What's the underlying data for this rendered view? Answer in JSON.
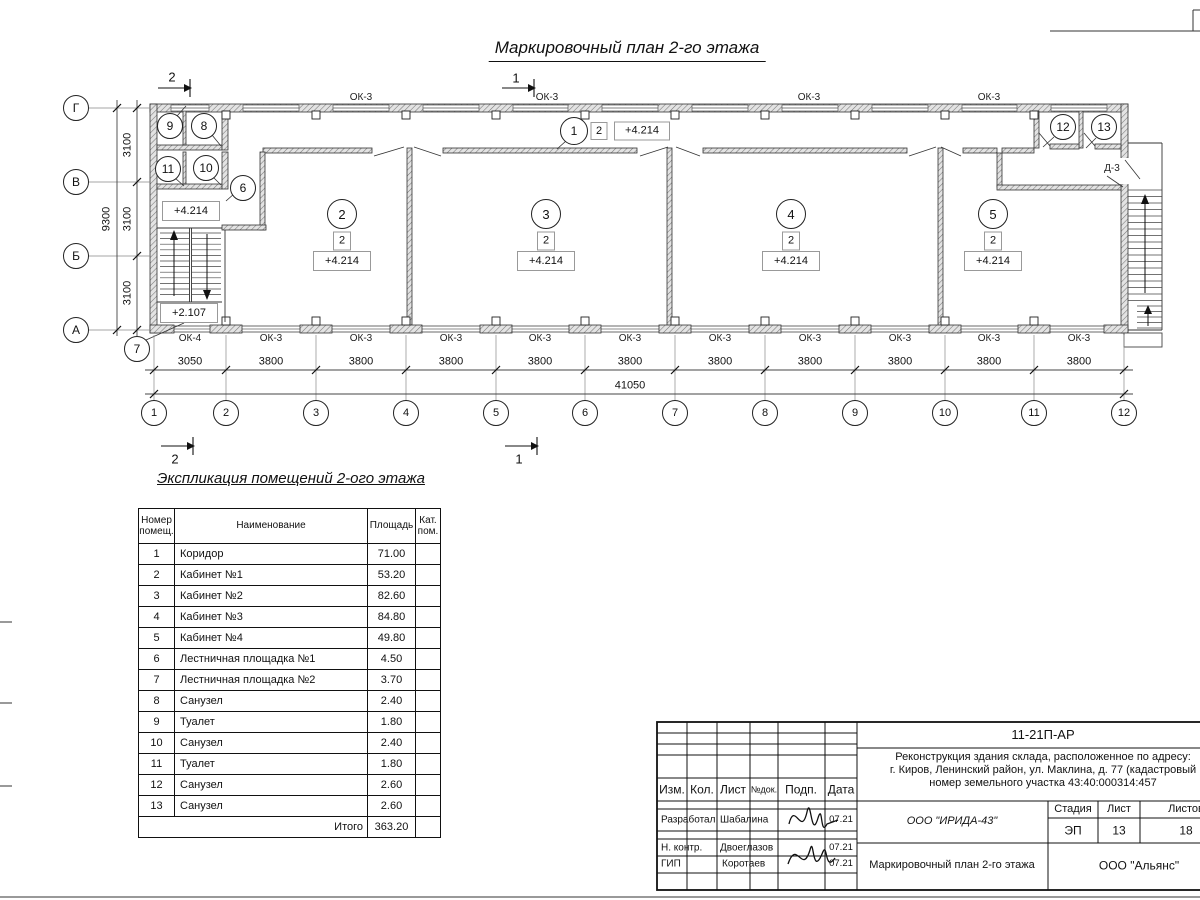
{
  "title": "Маркировочный план 2-го этажа",
  "plan": {
    "section_marks": {
      "top_left": "2",
      "top_mid": "1",
      "bottom_left": "2",
      "bottom_mid": "1"
    },
    "grid": {
      "cols": [
        "1",
        "2",
        "3",
        "4",
        "5",
        "6",
        "7",
        "8",
        "9",
        "10",
        "11",
        "12"
      ],
      "rows": [
        "Г",
        "В",
        "Б",
        "А"
      ]
    },
    "dims": {
      "bottom": [
        "3050",
        "3800",
        "3800",
        "3800",
        "3800",
        "3800",
        "3800",
        "3800",
        "3800",
        "3800",
        "3800"
      ],
      "total": "41050",
      "left": [
        "3100",
        "3100",
        "3100"
      ],
      "left_total": "9300"
    },
    "windows": {
      "top": [
        "ОК-3",
        "ОК-3",
        "ОК-3",
        "ОК-3"
      ],
      "bottom": [
        "ОК-4",
        "ОК-3",
        "ОК-3",
        "ОК-3",
        "ОК-3",
        "ОК-3",
        "ОК-3",
        "ОК-3",
        "ОК-3",
        "ОК-3",
        "ОК-3"
      ]
    },
    "corridor": {
      "no": "1",
      "type": "2",
      "elev": "+4.214"
    },
    "main_rooms": [
      {
        "no": "2",
        "type": "2",
        "elev": "+4.214"
      },
      {
        "no": "3",
        "type": "2",
        "elev": "+4.214"
      },
      {
        "no": "4",
        "type": "2",
        "elev": "+4.214"
      },
      {
        "no": "5",
        "type": "2",
        "elev": "+4.214"
      }
    ],
    "small_rooms": [
      "9",
      "8",
      "11",
      "10",
      "6",
      "7",
      "12",
      "13"
    ],
    "stair": {
      "upper": "+4.214",
      "lower": "+2.107"
    },
    "door_label": "Д-3"
  },
  "schedule": {
    "heading": "Экспликация помещений 2-ого этажа",
    "columns": [
      "Номер помещ.",
      "Наименование",
      "Площадь",
      "Кат. пом."
    ],
    "rows": [
      [
        "1",
        "Коридор",
        "71.00"
      ],
      [
        "2",
        "Кабинет №1",
        "53.20"
      ],
      [
        "3",
        "Кабинет №2",
        "82.60"
      ],
      [
        "4",
        "Кабинет №3",
        "84.80"
      ],
      [
        "5",
        "Кабинет №4",
        "49.80"
      ],
      [
        "6",
        "Лестничная площадка №1",
        "4.50"
      ],
      [
        "7",
        "Лестничная площадка №2",
        "3.70"
      ],
      [
        "8",
        "Санузел",
        "2.40"
      ],
      [
        "9",
        "Туалет",
        "1.80"
      ],
      [
        "10",
        "Санузел",
        "2.40"
      ],
      [
        "11",
        "Туалет",
        "1.80"
      ],
      [
        "12",
        "Санузел",
        "2.60"
      ],
      [
        "13",
        "Санузел",
        "2.60"
      ]
    ],
    "total_label": "Итого",
    "total_value": "363.20"
  },
  "title_block": {
    "doc_number": "11-21П-АР",
    "address_lines": [
      "Реконструкция здания склада, расположенное по адресу:",
      "г. Киров, Ленинский район, ул. Маклина, д. 77 (кадастровый",
      "номер земельного участка 43:40:000314:457"
    ],
    "cols": [
      "Изм.",
      "Кол.",
      "Лист",
      "№док.",
      "Подп.",
      "Дата"
    ],
    "roles": [
      {
        "role": "Разработал",
        "name": "Шабалина",
        "date": "07.21"
      },
      {
        "role": "Н. контр.",
        "name": "Двоеглазов",
        "date": "07.21"
      },
      {
        "role": "ГИП",
        "name": "Коротаев",
        "date": "07.21"
      }
    ],
    "company": "ООО \"ИРИДА-43\"",
    "stage_label": "Стадия",
    "sheet_label": "Лист",
    "sheets_label": "Листов",
    "stage": "ЭП",
    "sheet": "13",
    "sheets": "18",
    "drawing_name": "Маркировочный план 2-го этажа",
    "contractor": "ООО \"Альянс\""
  }
}
